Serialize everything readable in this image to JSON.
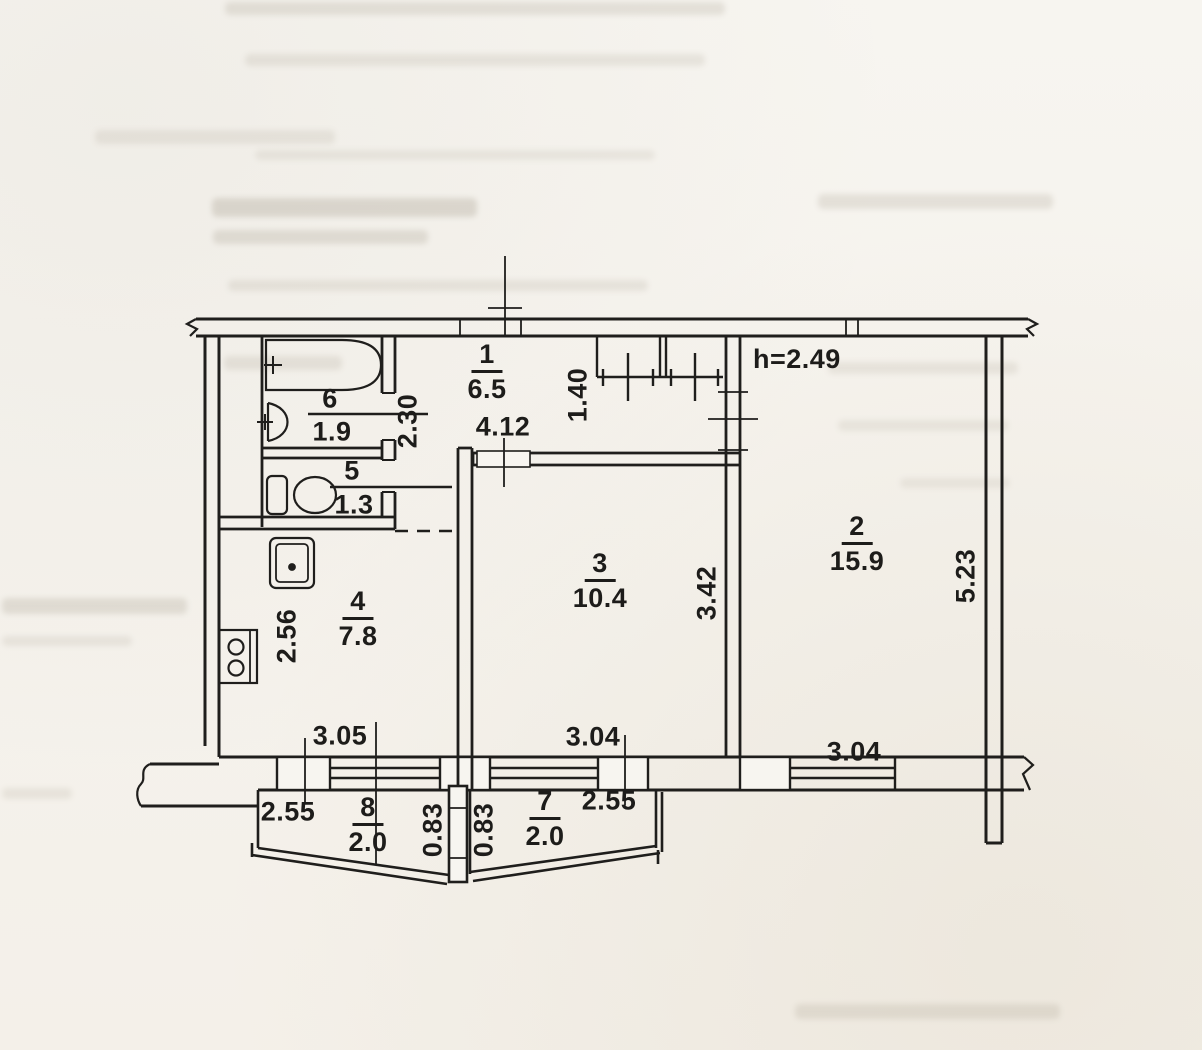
{
  "plan": {
    "title": "apartment-floor-plan",
    "height_note": "h=2.49",
    "rooms": [
      {
        "number": "1",
        "area": "6.5"
      },
      {
        "number": "2",
        "area": "15.9"
      },
      {
        "number": "3",
        "area": "10.4"
      },
      {
        "number": "4",
        "area": "7.8"
      },
      {
        "number": "5",
        "area": "1.3"
      },
      {
        "number": "6",
        "area": "1.9"
      },
      {
        "number": "7",
        "area": "2.0"
      },
      {
        "number": "8",
        "area": "2.0"
      }
    ],
    "dimensions": {
      "hall_length": "4.12",
      "closet_width": "1.40",
      "bath_block_depth": "2.30",
      "room2_depth": "5.23",
      "room3_depth": "3.42",
      "kitchen_depth": "2.56",
      "kitchen_window_width": "3.05",
      "room3_window_width": "3.04",
      "room2_window_width": "3.04",
      "balcony8_width": "2.55",
      "balcony7_width": "2.55",
      "balcony8_depth": "0.83",
      "balcony7_depth": "0.83"
    },
    "colors": {
      "ink": "#1f1e1c",
      "paper": "#f6f3ee"
    }
  }
}
